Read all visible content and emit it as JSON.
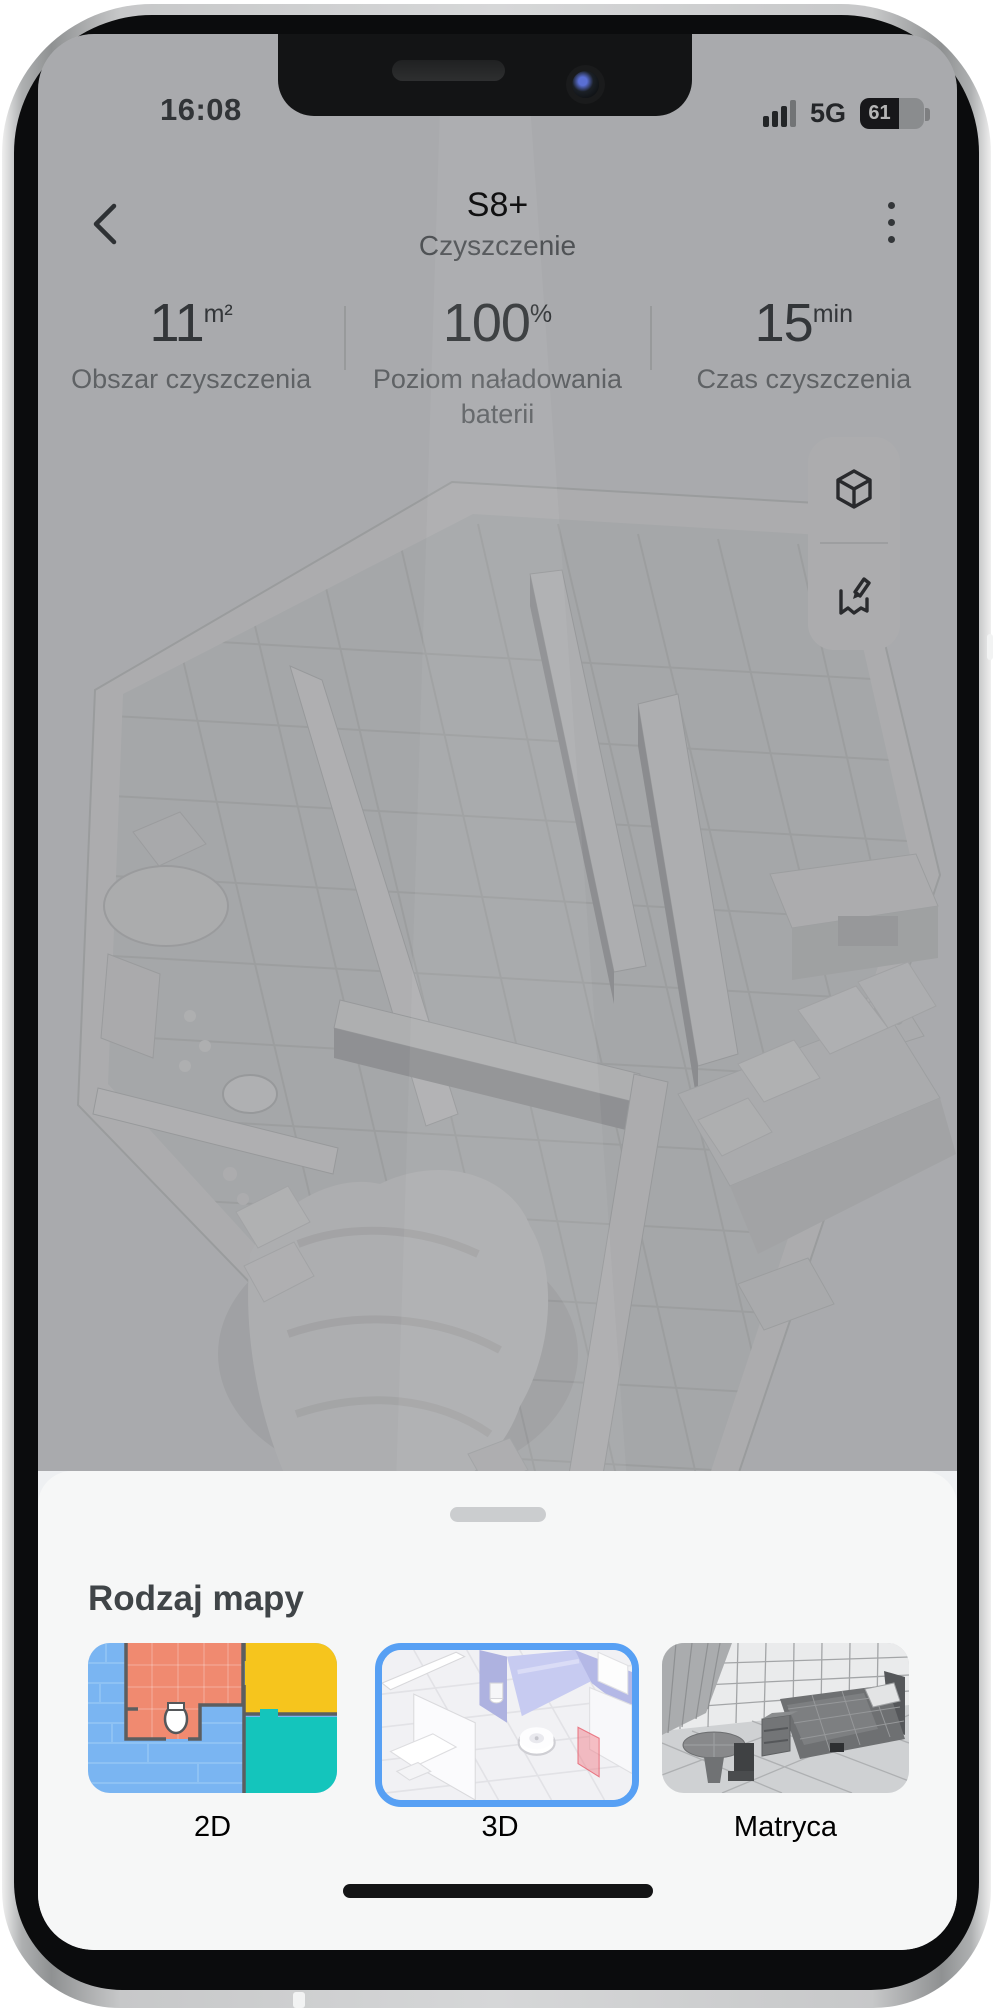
{
  "status_bar": {
    "time": "16:08",
    "network": "5G",
    "battery_percent": "61"
  },
  "header": {
    "title": "S8+",
    "subtitle": "Czyszczenie"
  },
  "stats": [
    {
      "value": "11",
      "unit": "m²",
      "label": "Obszar czyszczenia"
    },
    {
      "value": "100",
      "unit": "%",
      "label": "Poziom naładowania baterii"
    },
    {
      "value": "15",
      "unit": "min",
      "label": "Czas czyszczenia"
    }
  ],
  "map_tools": [
    {
      "icon": "cube-3d-icon"
    },
    {
      "icon": "edit-map-icon"
    }
  ],
  "bottom_sheet": {
    "title": "Rodzaj mapy",
    "options": [
      {
        "label": "2D",
        "selected": false
      },
      {
        "label": "3D",
        "selected": true
      },
      {
        "label": "Matryca",
        "selected": false
      }
    ]
  },
  "colors": {
    "accent_blue": "#57a0f4",
    "map2d_blue": "#7ab5f2",
    "map2d_salmon": "#f08a70",
    "map2d_yellow": "#f6c51d",
    "map2d_teal": "#14c5bc",
    "sheet_bg": "#f6f7f7",
    "dim": "rgba(10,11,12,0.30)"
  }
}
